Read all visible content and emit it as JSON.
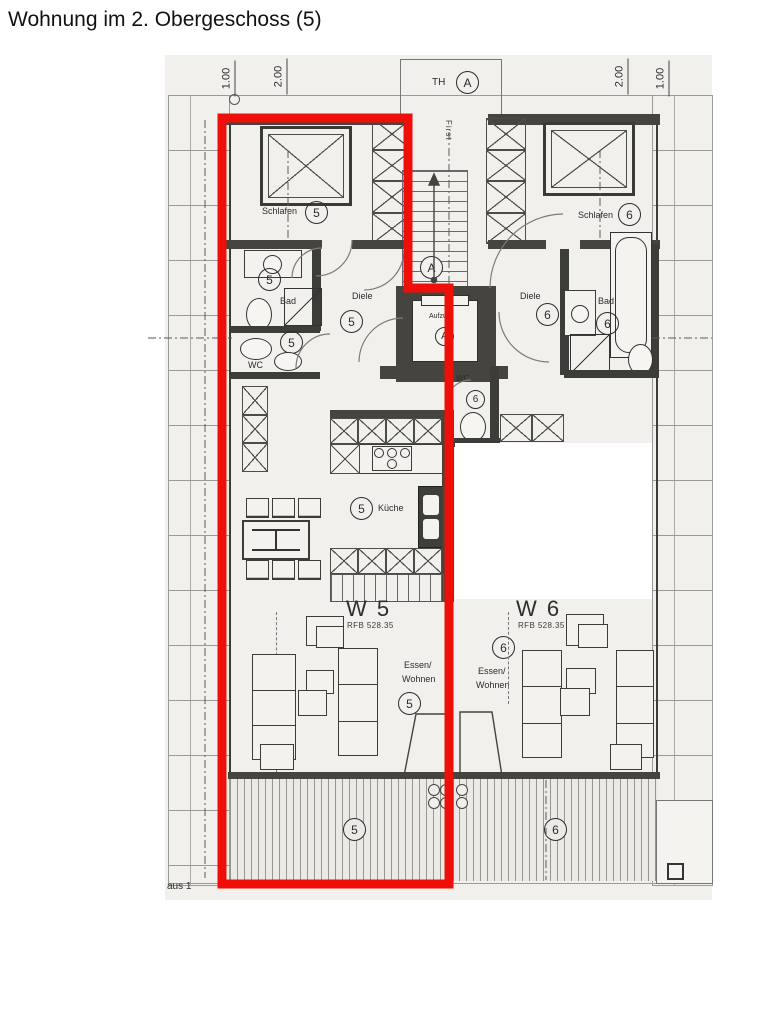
{
  "title": "Wohnung im 2. Obergeschoss (5)",
  "footer_note": "aus 1",
  "dimensions": {
    "left": [
      "1.00",
      "2.00"
    ],
    "right": [
      "2.00",
      "1.00"
    ]
  },
  "core": {
    "stair_hall_label": "TH",
    "section_marker": "A",
    "stair_section_marker": "A",
    "ridge_label": "First",
    "elevator_label": "Aufzug",
    "elevator_marker": "A"
  },
  "unit5": {
    "number": "5",
    "label": "W 5",
    "level_note": "RFB 528.35",
    "rooms": {
      "bedroom": "Schlafen",
      "bathroom": "Bad",
      "toilet": "WC",
      "hallway": "Diele",
      "kitchen": "Küche",
      "living_line1": "Essen/",
      "living_line2": "Wohnen"
    }
  },
  "unit6": {
    "number": "6",
    "label": "W 6",
    "level_note": "RFB 528.35",
    "rooms": {
      "bedroom": "Schlafen",
      "bathroom": "Bad",
      "toilet": "WC",
      "hallway": "Diele",
      "living_line1": "Essen/",
      "living_line2": "Wohnen"
    }
  },
  "colors": {
    "highlight": "#ee1008",
    "walls": "#45443e",
    "paper": "#f1f0ed"
  }
}
